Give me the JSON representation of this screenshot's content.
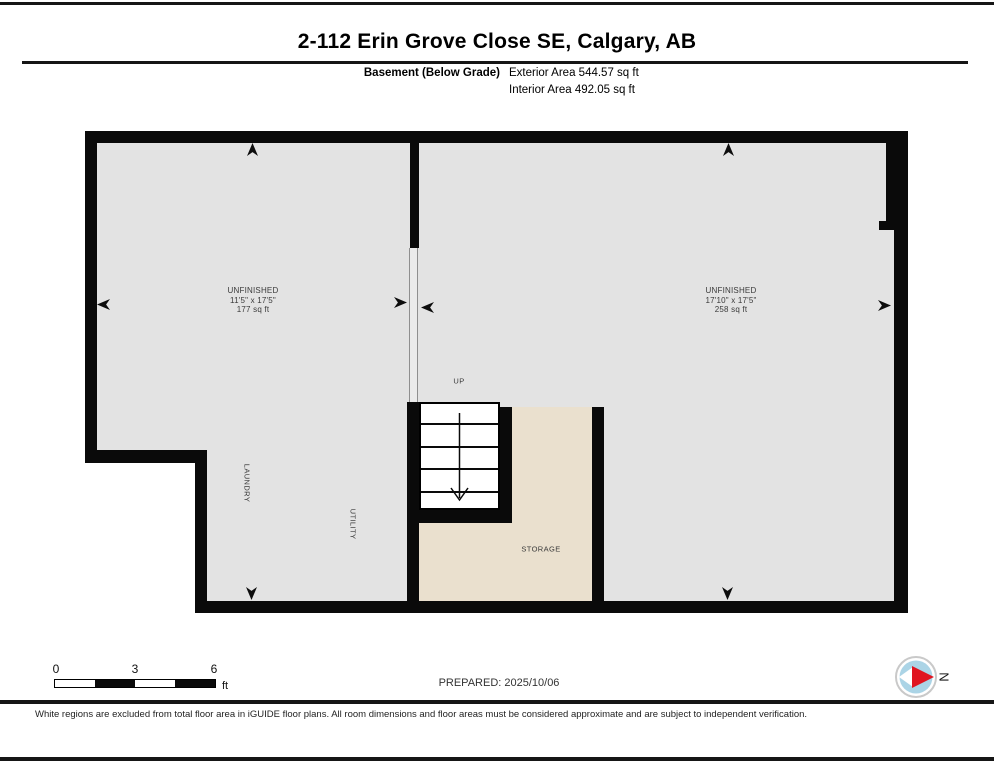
{
  "header": {
    "title": "2-112 Erin Grove Close SE, Calgary, AB",
    "floor_label": "Basement (Below Grade)",
    "exterior_area": "Exterior Area 544.57 sq ft",
    "interior_area": "Interior Area 492.05 sq ft"
  },
  "plan": {
    "rooms": [
      {
        "name": "UNFINISHED",
        "dims": "11'5\" x 17'5\"",
        "area": "177 sq ft"
      },
      {
        "name": "UNFINISHED",
        "dims": "17'10\" x 17'5\"",
        "area": "258 sq ft"
      }
    ],
    "labels": {
      "up": "UP",
      "laundry": "LAUNDRY",
      "utility": "UTILITY",
      "storage": "STORAGE"
    }
  },
  "footer_bar": {
    "scale": {
      "t0": "0",
      "t3": "3",
      "t6": "6",
      "unit": "ft"
    },
    "prepared": "PREPARED: 2025/10/06",
    "compass_n": "N"
  },
  "disclaimer": "White regions are excluded from total floor area in iGUIDE floor plans. All room dimensions and floor areas must be considered approximate and are subject to independent verification.",
  "colors": {
    "wall": "#0a0a0a",
    "room_gray": "#e3e3e3",
    "storage_beige": "#eae0ce",
    "compass_blue": "#abd4e6",
    "compass_red": "#e01420"
  }
}
